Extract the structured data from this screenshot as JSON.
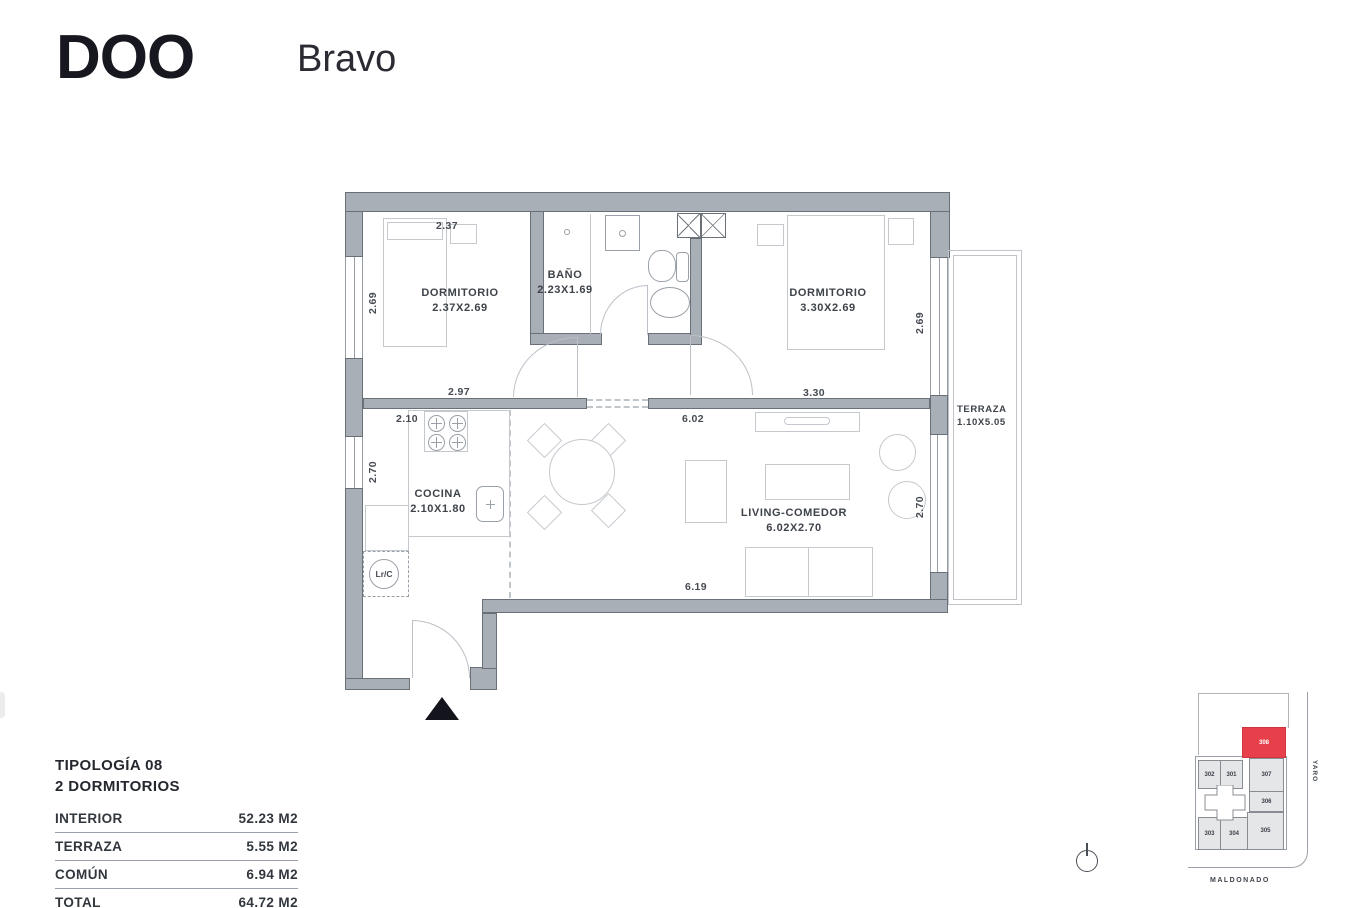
{
  "header": {
    "brand": "DOO",
    "project": "Bravo"
  },
  "plan": {
    "rooms": {
      "dorm1": {
        "name": "DORMITORIO",
        "size": "2.37X2.69"
      },
      "bano": {
        "name": "BAÑO",
        "size": "2.23X1.69"
      },
      "dorm2": {
        "name": "DORMITORIO",
        "size": "3.30X2.69"
      },
      "cocina": {
        "name": "COCINA",
        "size": "2.10X1.80"
      },
      "living": {
        "name": "LIVING-COMEDOR",
        "size": "6.02X2.70"
      },
      "terraza": {
        "name": "TERRAZA",
        "size": "1.10X5.05"
      }
    },
    "laundry_label": "Lr/C",
    "dimensions": {
      "dorm1_top": "2.37",
      "dorm1_left": "2.69",
      "dorm1_bottom": "2.97",
      "cocina_top": "2.10",
      "cocina_left": "2.70",
      "living_top": "6.02",
      "dorm2_bottom": "3.30",
      "dorm2_right": "2.69",
      "living_right": "2.70",
      "living_bottom": "6.19"
    }
  },
  "summary": {
    "title_line1": "TIPOLOGÍA 08",
    "title_line2": "2 DORMITORIOS",
    "rows": [
      {
        "label": "INTERIOR",
        "value": "52.23 M2"
      },
      {
        "label": "TERRAZA",
        "value": "5.55 M2"
      },
      {
        "label": "COMÚN",
        "value": "6.94 M2"
      },
      {
        "label": "TOTAL",
        "value": "64.72 M2"
      }
    ]
  },
  "sitemap": {
    "highlight_unit": "308",
    "highlight_color": "#e8404a",
    "units": [
      {
        "label": "302"
      },
      {
        "label": "301"
      },
      {
        "label": "307"
      },
      {
        "label": "306"
      },
      {
        "label": "303"
      },
      {
        "label": "304"
      },
      {
        "label": "305"
      }
    ],
    "streets": {
      "right": "YARO",
      "bottom": "MALDONADO"
    }
  },
  "colors": {
    "wall": "#a9afb7",
    "wall_border": "#697077",
    "line": "#c5c9ce",
    "text": "#3e434a"
  }
}
